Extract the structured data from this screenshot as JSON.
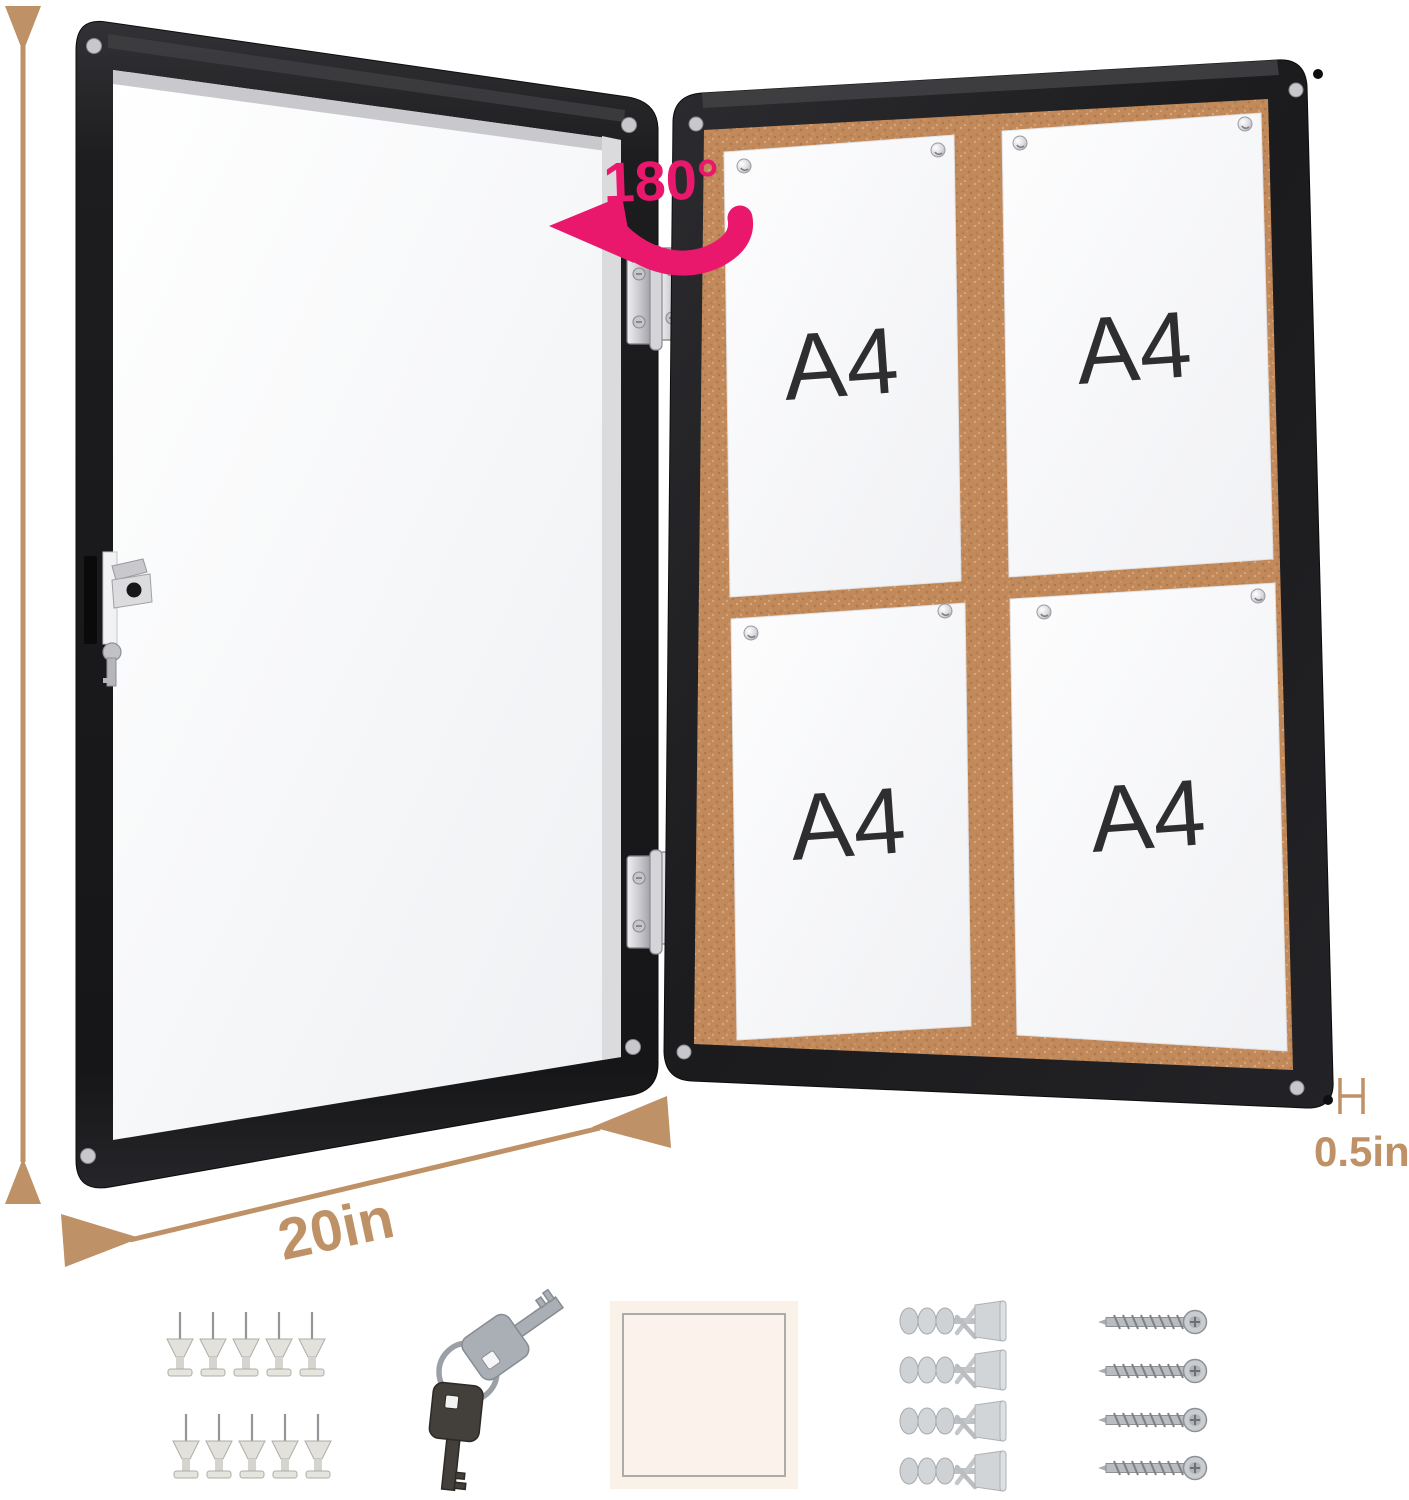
{
  "labels": {
    "height": "26in",
    "width": "20in",
    "depth": "0.5in",
    "rotation": "180°"
  },
  "board": {
    "type": "enclosed cork notice board, black frame, door opened flat",
    "papers": [
      {
        "label": "A4"
      },
      {
        "label": "A4"
      },
      {
        "label": "A4"
      },
      {
        "label": "A4"
      }
    ]
  },
  "accessories": [
    {
      "name": "push-pin",
      "count": 10
    },
    {
      "name": "key",
      "count": 2
    },
    {
      "name": "adhesive-pad",
      "count": 1
    },
    {
      "name": "wall-anchor",
      "count": 4
    },
    {
      "name": "mounting-screw",
      "count": 4
    }
  ],
  "colors": {
    "dimension_tan": "#BE9166",
    "annotation_pink": "#E9186C",
    "frame_black": "#1C1C1E",
    "cork": "#C28A5B",
    "paper_white": "#F7F7F9",
    "chrome": "#D8D8DC"
  }
}
